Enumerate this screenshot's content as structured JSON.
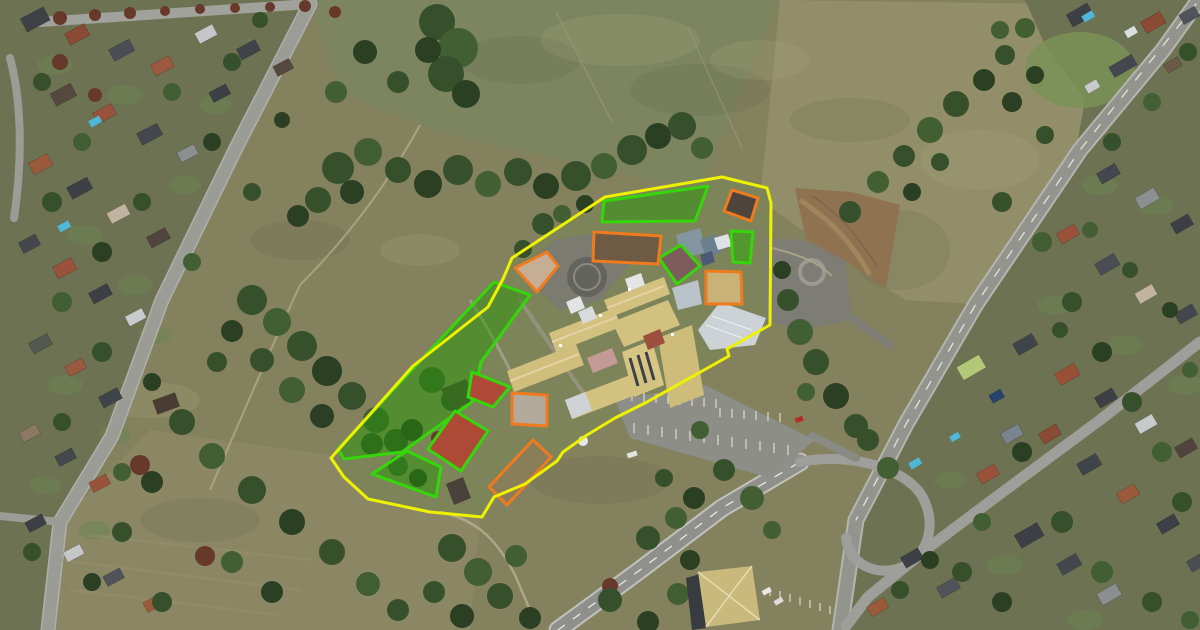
{
  "scene": {
    "title": "aerial-satellite-view-school-campus-with-zone-overlays",
    "canvas": {
      "width": 1200,
      "height": 630
    }
  },
  "palette": {
    "boundary_yellow": "#eef200",
    "zone_green": "#35d60a",
    "zone_orange": "#f07b1e",
    "green_tint": "rgba(34,150,4,0.46)",
    "court_red": "#b04a38",
    "sand_tan": "#c6ae95",
    "concrete_pale": "#b3a99a",
    "roof_maroon": "#7d5c5e",
    "roof_dark": "#4e443e",
    "roof_tan": "#c8b278",
    "dirt_brown": "#6f5a44",
    "dry_grass": "#8c7d58"
  },
  "style": {
    "zone_stroke_width": 3
  },
  "zones": [
    {
      "id": "zone-grass-north",
      "type": "green",
      "stroke": "#35d60a",
      "fill": "rgba(34,150,4,0.46)",
      "points": "604,201 708,186 695,221 602,222"
    },
    {
      "id": "zone-grass-northeast",
      "type": "green",
      "stroke": "#35d60a",
      "fill": "rgba(40,170,6,0.5)",
      "points": "731,231 753,232 750,263 733,262"
    },
    {
      "id": "zone-grass-west-strip",
      "type": "green",
      "stroke": "#35d60a",
      "fill": "rgba(34,150,4,0.46)",
      "points": "494,282 530,295 481,362 472,402 402,452 344,459 338,449"
    },
    {
      "id": "zone-grass-southwest",
      "type": "green",
      "stroke": "#35d60a",
      "fill": "rgba(34,150,4,0.46)",
      "points": "372,474 407,451 441,467 436,497"
    },
    {
      "id": "zone-roof-maroon",
      "type": "green",
      "stroke": "#35d60a",
      "fill": "#7d5c5e",
      "points": "659,258 681,245 700,266 677,284"
    },
    {
      "id": "zone-court-upper-red",
      "type": "green",
      "stroke": "#35d60a",
      "fill": "#b04a38",
      "points": "472,372 510,387 493,407 468,397"
    },
    {
      "id": "zone-court-lower-red",
      "type": "green",
      "stroke": "#35d60a",
      "fill": "#ad4a36",
      "points": "455,411 488,431 461,471 428,449"
    },
    {
      "id": "zone-roof-dark-northeast",
      "type": "orange",
      "stroke": "#f07b1e",
      "fill": "#4e443e",
      "points": "732,190 758,198 751,221 724,211"
    },
    {
      "id": "zone-dirt-yard",
      "type": "orange",
      "stroke": "#f07b1e",
      "fill": "#6f5a44",
      "points": "594,232 661,236 658,264 593,261"
    },
    {
      "id": "zone-sandpit",
      "type": "orange",
      "stroke": "#f07b1e",
      "fill": "#c6ae95",
      "points": "515,268 547,252 558,266 537,292"
    },
    {
      "id": "zone-court-west",
      "type": "orange",
      "stroke": "#f07b1e",
      "fill": "#b3a99a",
      "points": "512,393 547,395 547,426 512,424"
    },
    {
      "id": "zone-roof-tan-northeast",
      "type": "orange",
      "stroke": "#f07b1e",
      "fill": "#c8b278",
      "points": "706,271 741,272 742,304 706,304"
    },
    {
      "id": "zone-dry-grass-south",
      "type": "orange",
      "stroke": "#f07b1e",
      "fill": "rgba(140,125,88,0.85)",
      "points": "533,440 551,457 507,505 489,487"
    },
    {
      "id": "site-boundary",
      "type": "boundary",
      "stroke": "#eef200",
      "fill": "none",
      "points": "605,197 722,177 767,188 771,203 770,325 727,349 729,356 647,402 615,418 587,435 563,452 557,461 525,484 494,497 482,517 430,512 368,499 344,477 331,458 413,366 488,307 503,279 512,258"
    }
  ]
}
